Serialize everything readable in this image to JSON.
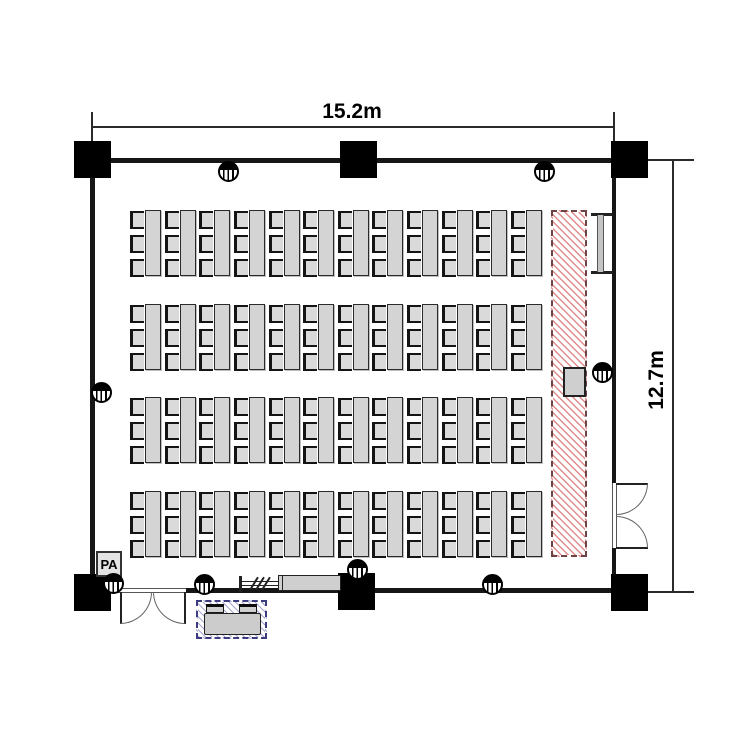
{
  "room": {
    "type": "seminar-room-floor-plan",
    "width_label": "15.2m",
    "height_label": "12.7m",
    "pa_label": "PA"
  },
  "seating": {
    "rows": 4,
    "tables_per_row": 12,
    "chairs_per_table": 3,
    "total_seats": 144
  },
  "features": {
    "stage": "hatched-stage-strip-right",
    "podium": "podium-on-stage",
    "screen": "wall-mounted-screen-right",
    "doors": [
      "double-door-bottom-left",
      "double-door-right"
    ],
    "outlet_count": 8,
    "operator_desk": "av-operator-desk-outside-bottom",
    "columns": 6
  },
  "colors": {
    "wall": "#161616",
    "furniture_fill": "#d4d4d4",
    "furniture_border": "#2a2a2a",
    "stage_hatch": "#d66464",
    "stage_border": "#6e4343",
    "operator_hatch": "#5c61af",
    "operator_border": "#3c3c80"
  }
}
